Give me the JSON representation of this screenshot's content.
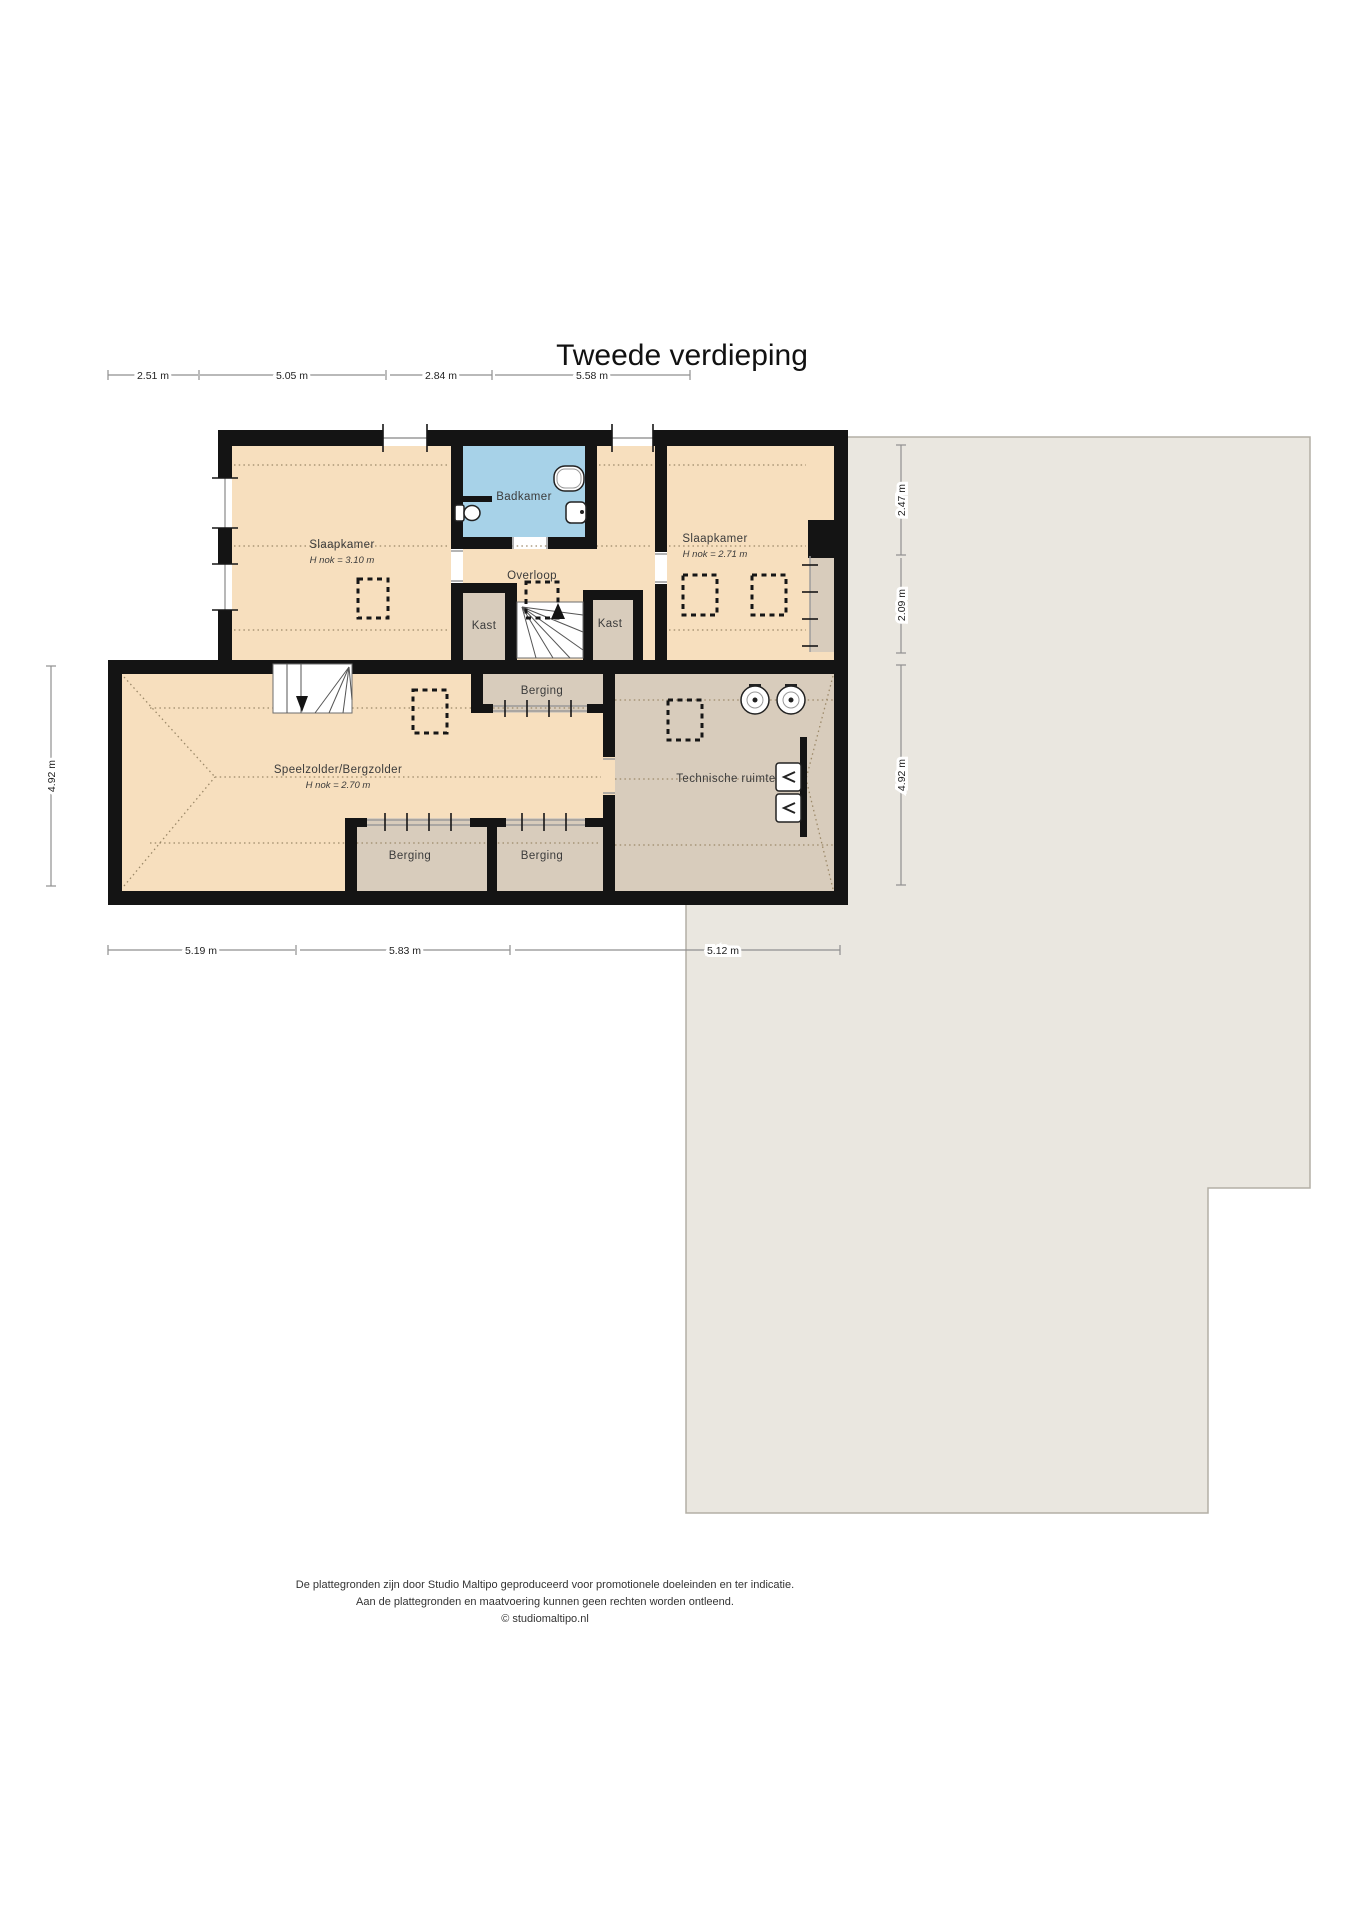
{
  "title": "Tweede verdieping",
  "rooms": {
    "slaapkamer_left": {
      "label": "Slaapkamer",
      "height": "H nok = 3.10 m"
    },
    "badkamer": {
      "label": "Badkamer"
    },
    "overloop": {
      "label": "Overloop"
    },
    "kast_left": {
      "label": "Kast"
    },
    "kast_right": {
      "label": "Kast"
    },
    "slaapkamer_right": {
      "label": "Slaapkamer",
      "height": "H nok = 2.71 m"
    },
    "speelzolder": {
      "label": "Speelzolder/Bergzolder",
      "height": "H nok = 2.70 m"
    },
    "berging_top": {
      "label": "Berging"
    },
    "berging_bottom_left": {
      "label": "Berging"
    },
    "berging_bottom_right": {
      "label": "Berging"
    },
    "technische_ruimte": {
      "label": "Technische ruimte"
    }
  },
  "dimensions": {
    "top": [
      "2.51 m",
      "5.05 m",
      "2.84 m",
      "5.58 m"
    ],
    "bottom": [
      "5.19 m",
      "5.83 m",
      "5.12 m"
    ],
    "left": [
      "4.92 m"
    ],
    "right": [
      "2.47 m",
      "2.09 m",
      "4.92 m"
    ]
  },
  "footer": {
    "line1": "De plattegronden zijn door Studio Maltipo geproduceerd voor promotionele doeleinden en ter indicatie.",
    "line2": "Aan de plattegronden en maatvoering kunnen geen rechten worden ontleend.",
    "line3": "© studiomaltipo.nl"
  },
  "colors": {
    "floor": "#f7dfbe",
    "storage": "#d8ccbc",
    "bath": "#a7d2e8",
    "roof": "#eae7e0",
    "roof-border": "#b3afa5",
    "wall": "#141414",
    "dotted": "#9c8969",
    "dim": "#8f8f8f",
    "label": "#3b3b3b"
  }
}
